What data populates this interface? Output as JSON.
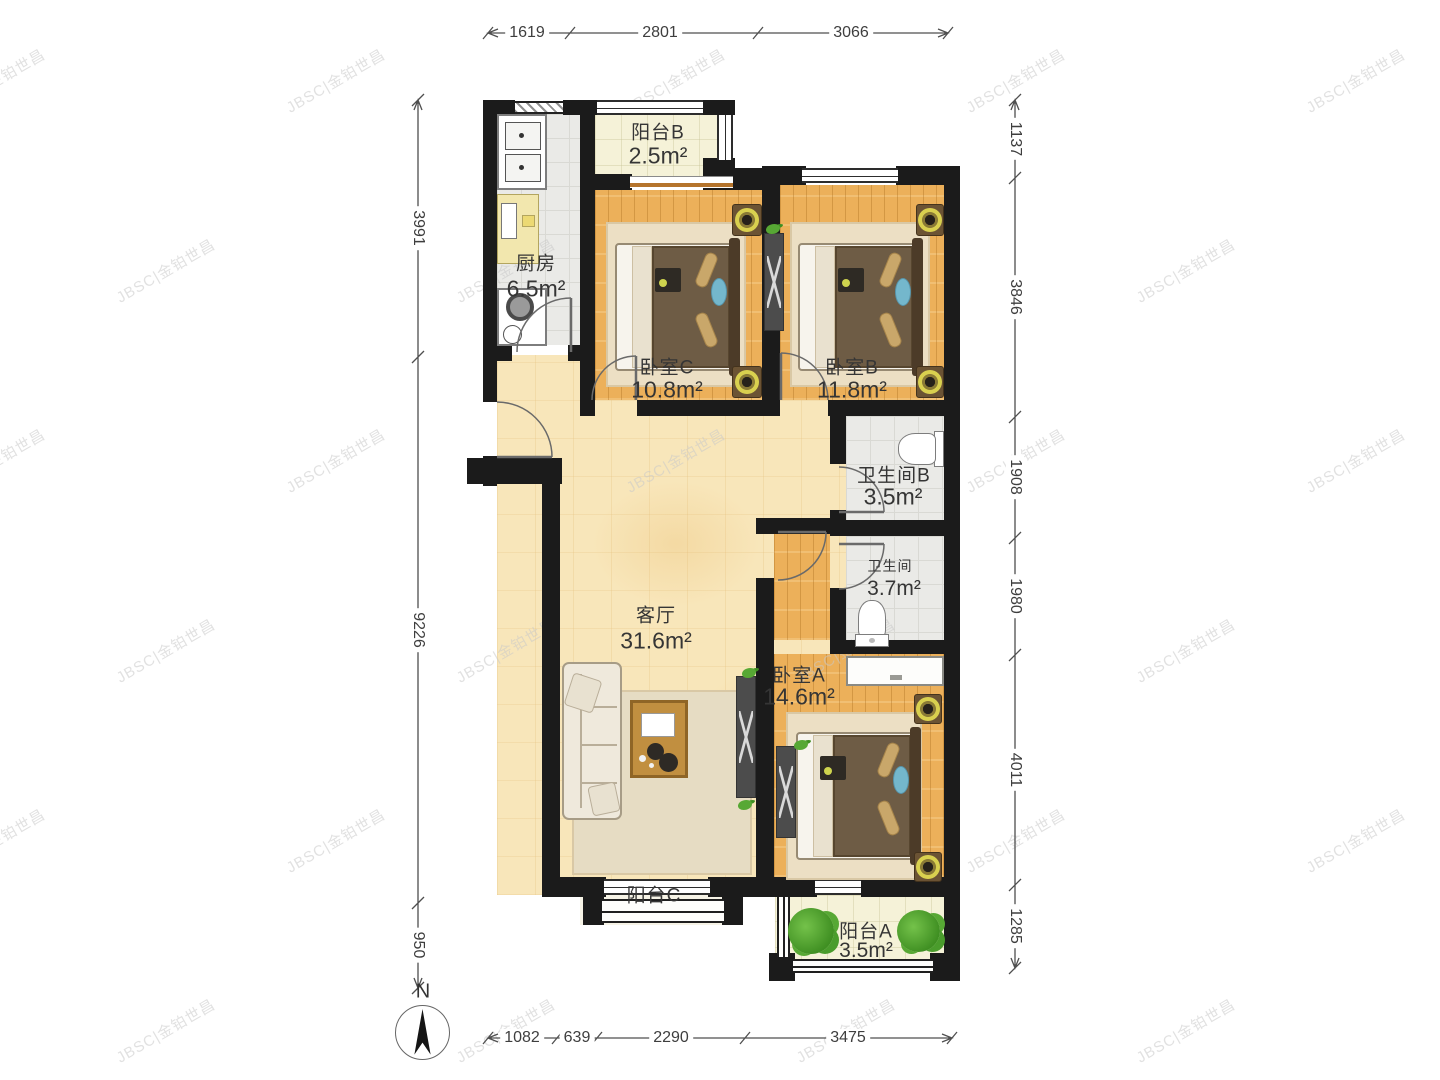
{
  "watermark": {
    "text": "JBSC|金铂世昌"
  },
  "compass": {
    "north_label": "N"
  },
  "rooms": [
    {
      "id": "balcony_b",
      "name": "阳台B",
      "area": "2.5m²"
    },
    {
      "id": "kitchen",
      "name": "厨房",
      "area": "6.5m²"
    },
    {
      "id": "bedroom_c",
      "name": "卧室C",
      "area": "10.8m²"
    },
    {
      "id": "bedroom_b",
      "name": "卧室B",
      "area": "11.8m²"
    },
    {
      "id": "bathroom_b",
      "name": "卫生间B",
      "area": "3.5m²"
    },
    {
      "id": "bathroom",
      "name": "卫生间",
      "area": "3.7m²"
    },
    {
      "id": "living_room",
      "name": "客厅",
      "area": "31.6m²"
    },
    {
      "id": "bedroom_a",
      "name": "卧室A",
      "area": "14.6m²"
    },
    {
      "id": "balcony_c",
      "name": "阳台C",
      "area": ""
    },
    {
      "id": "balcony_a",
      "name": "阳台A",
      "area": "3.5m²"
    }
  ],
  "dimensions": {
    "top": [
      "1619",
      "2801",
      "3066"
    ],
    "bottom": [
      "1082",
      "639",
      "2290",
      "3475"
    ],
    "left": [
      "3991",
      "9226",
      "950"
    ],
    "right": [
      "1137",
      "3846",
      "1908",
      "1980",
      "4011",
      "1285"
    ]
  }
}
